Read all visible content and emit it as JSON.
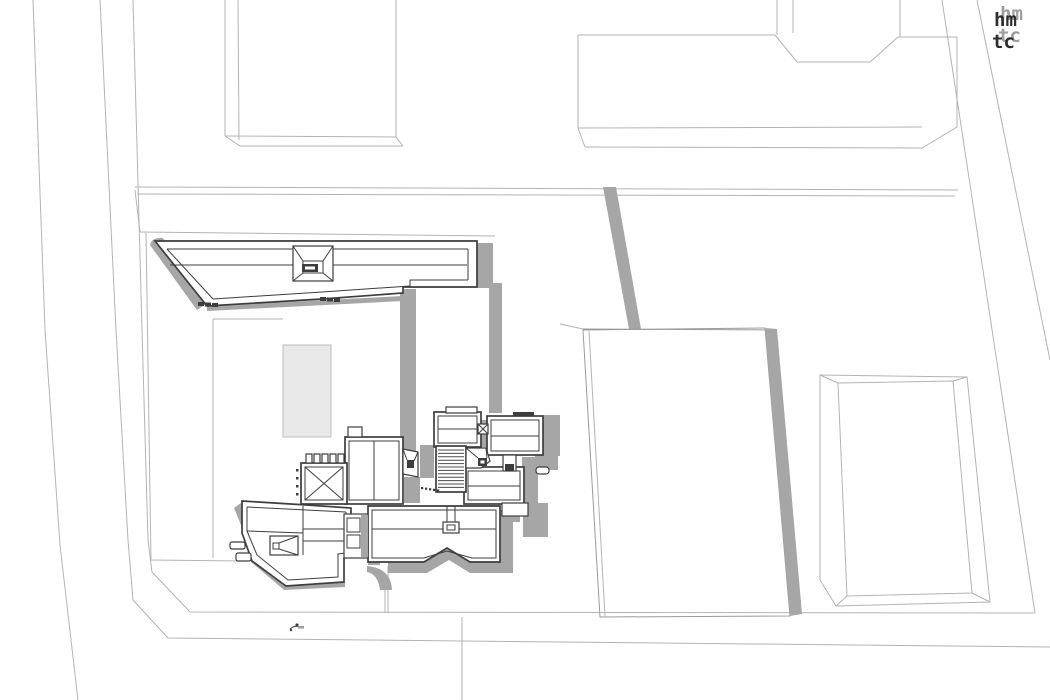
{
  "title": "axonometric architectural site plan",
  "canvas": {
    "width": 1050,
    "height": 700,
    "background": "#ffffff"
  },
  "palette": {
    "building_ink": "#3d3d3d",
    "cast_shadow": "#a6a6a6",
    "context_line": "#b3b3b3",
    "terrace_fill": "#e9e9e9",
    "logo_ink": "#2e2e2e",
    "logo_shadow": "#9e9e9e"
  },
  "logo": {
    "row1": "hm",
    "row2": "tc"
  },
  "drawing": {
    "main_building": "central roof plan with skylights, louvers and cast shadows",
    "context_buildings": 3,
    "neighbor_parcel": "white parallelogram block with shadow band",
    "site_marker": "small figure on sidewalk"
  }
}
